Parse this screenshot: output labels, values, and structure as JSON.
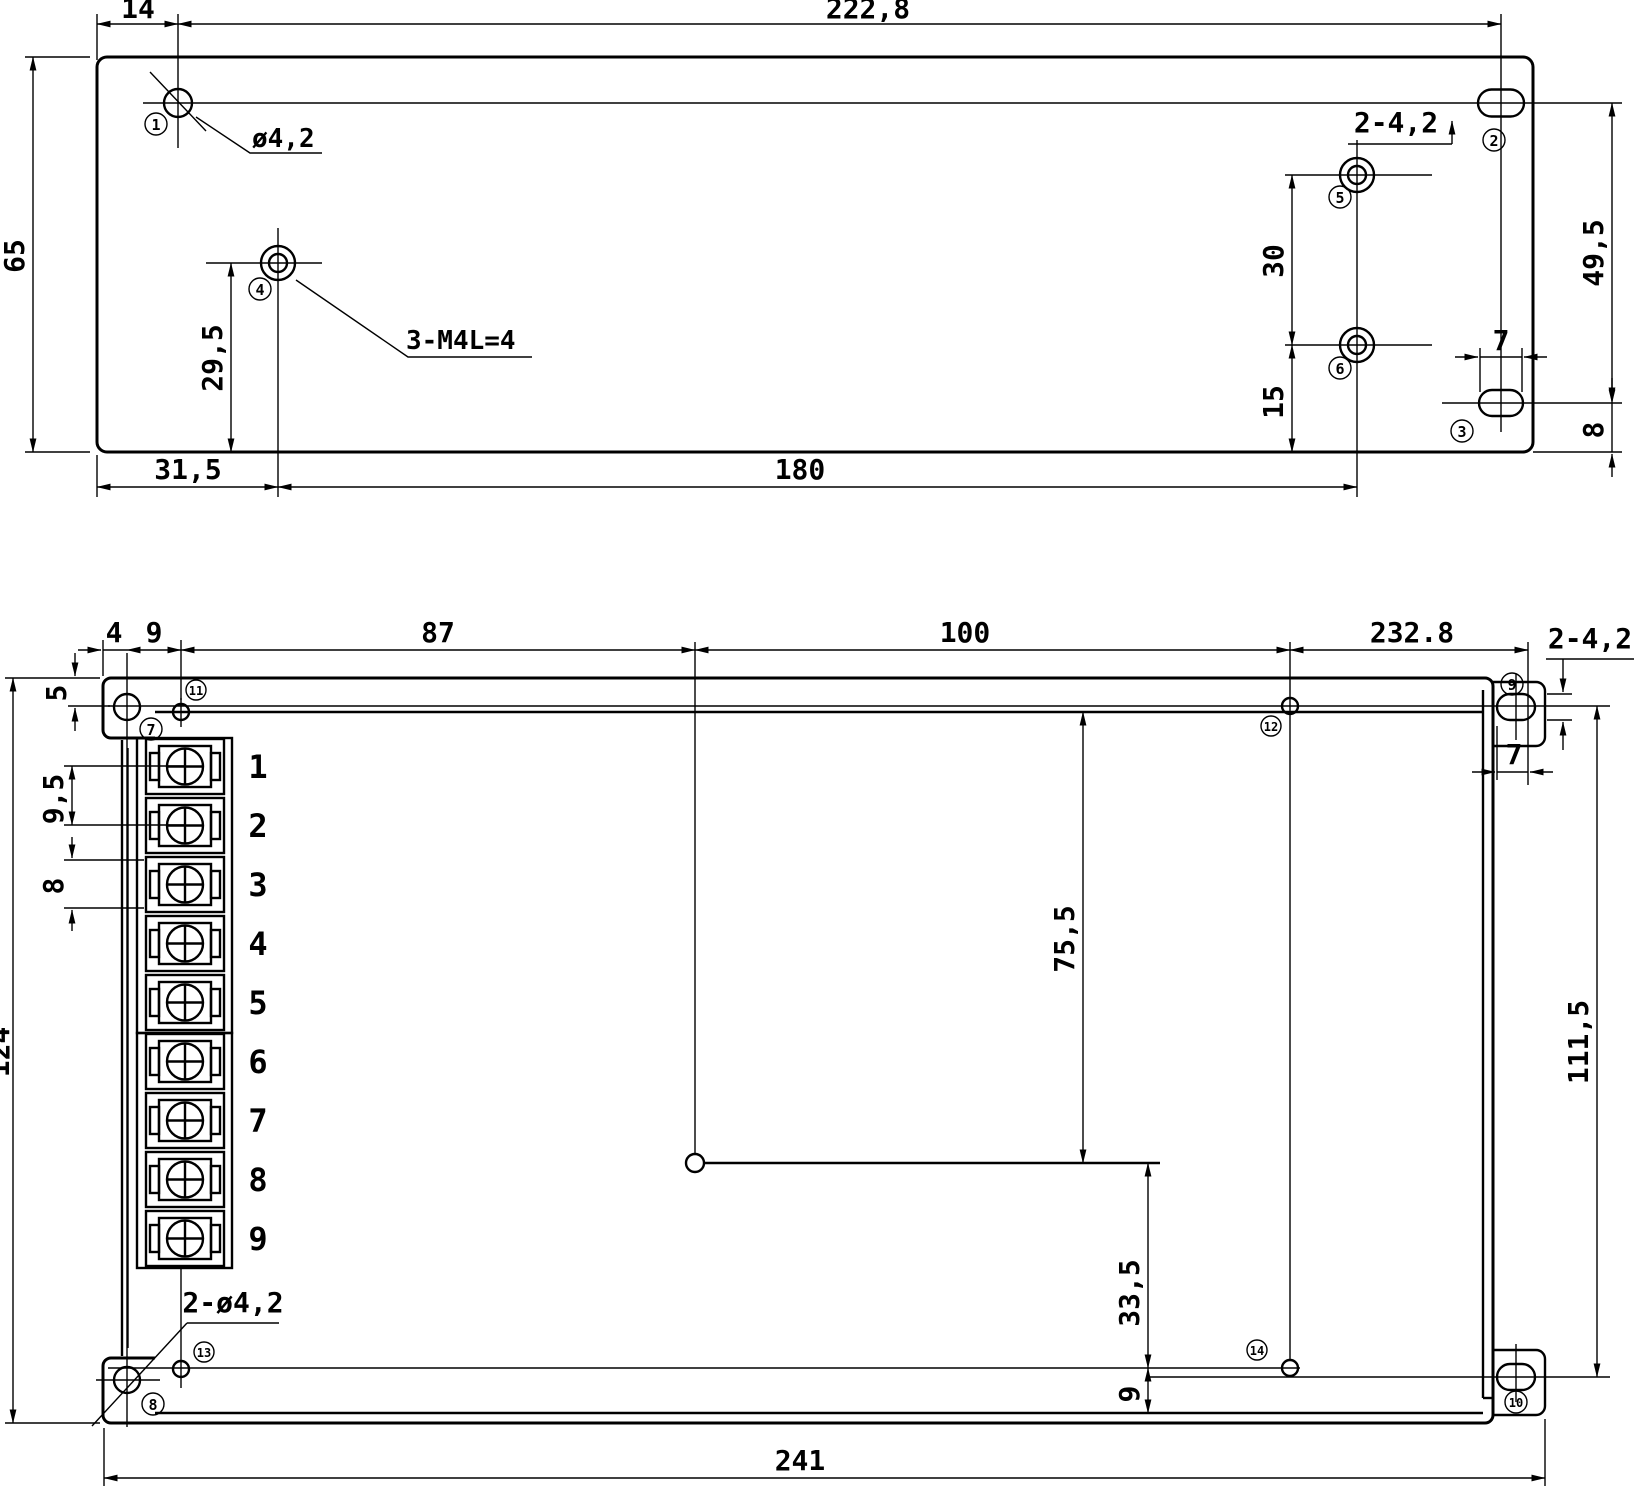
{
  "drawing": {
    "type": "mechanical-dimension-drawing",
    "units_style": "mm, comma decimal separator"
  },
  "top_view": {
    "dims": {
      "w14": "14",
      "w2228": "222,8",
      "h65": "65",
      "d295": "29,5",
      "d315": "31,5",
      "d180": "180",
      "d30": "30",
      "d15": "15",
      "d495": "49,5",
      "d7": "7",
      "d8": "8"
    },
    "labels": {
      "hole_dia": "ø4,2",
      "thread": "3-M4L=4",
      "slot_pair": "2-4,2"
    },
    "callouts": {
      "c1": "1",
      "c2": "2",
      "c3": "3",
      "c4": "4",
      "c5": "5",
      "c6": "6"
    }
  },
  "bottom_view": {
    "dims": {
      "d4": "4",
      "d9": "9",
      "d87": "87",
      "d100": "100",
      "d2328": "232.8",
      "d5": "5",
      "d95": "9,5",
      "d8": "8",
      "d124": "124",
      "d755": "75,5",
      "d335": "33,5",
      "d9b": "9",
      "d241": "241",
      "d7": "7",
      "d1115": "111,5"
    },
    "labels": {
      "slot_pair": "2-4,2",
      "hole_pair": "2-ø4,2"
    },
    "terminals": [
      "1",
      "2",
      "3",
      "4",
      "5",
      "6",
      "7",
      "8",
      "9"
    ],
    "callouts": {
      "c7": "7",
      "c8": "8",
      "c9": "9",
      "c10": "10",
      "c11": "11",
      "c12": "12",
      "c13": "13",
      "c14": "14"
    }
  }
}
